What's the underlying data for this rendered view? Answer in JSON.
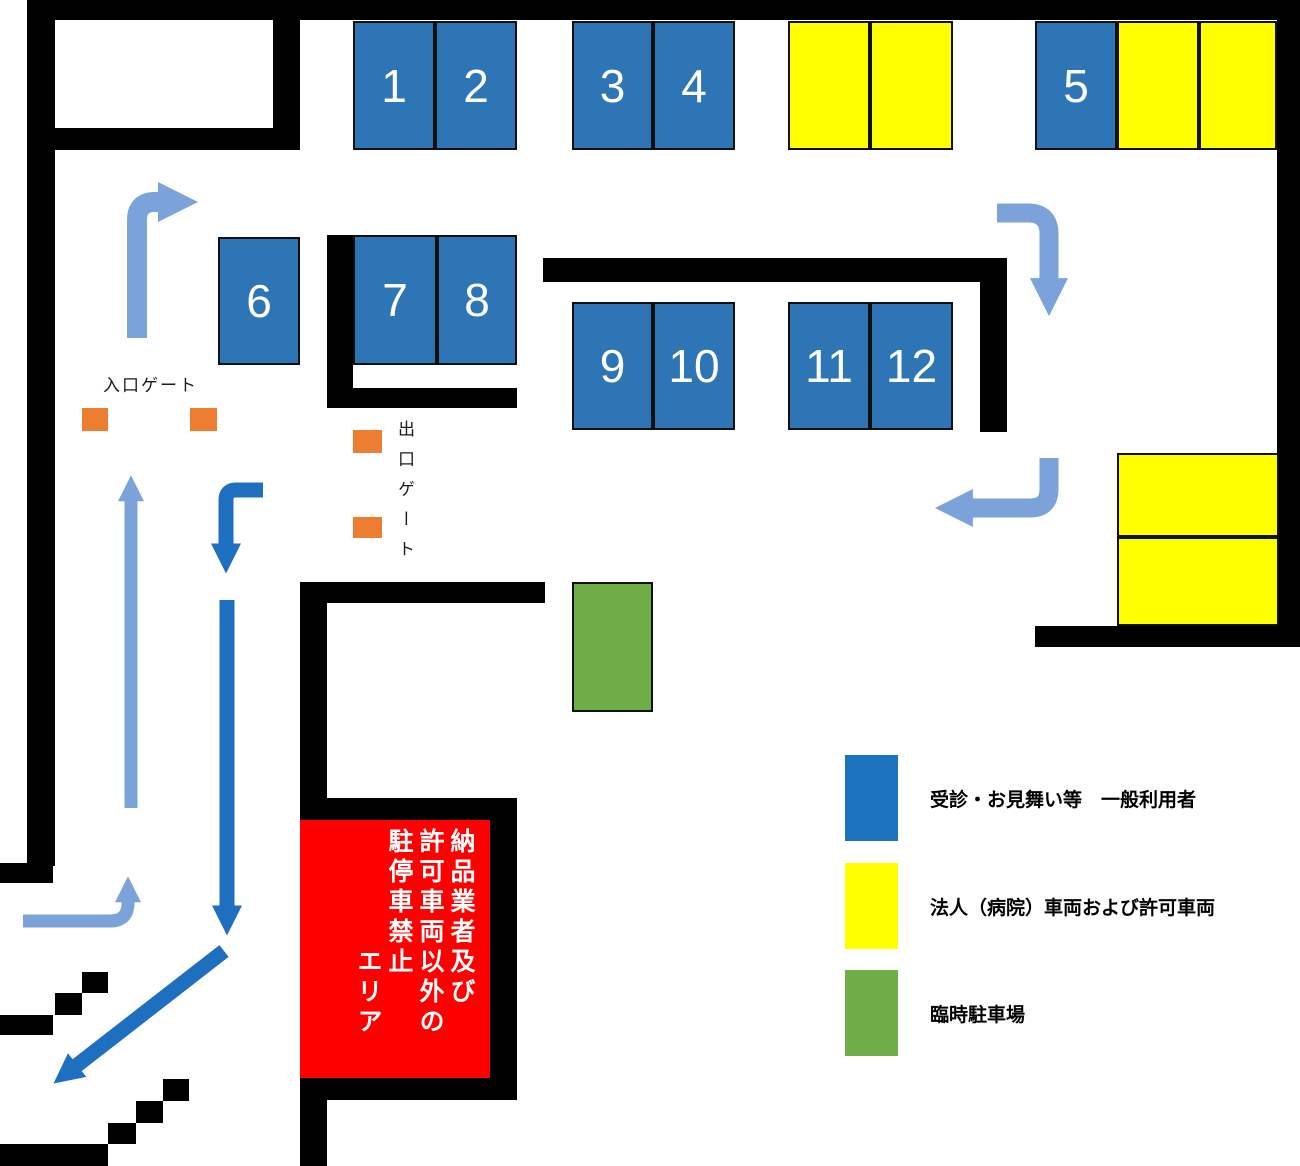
{
  "map": {
    "entrance_gate_label": "入口ゲート",
    "exit_gate_label": "出口ゲート",
    "stall_numbers": [
      "1",
      "2",
      "3",
      "4",
      "5",
      "6",
      "7",
      "8",
      "9",
      "10",
      "11",
      "12"
    ],
    "restricted_area_text": "納品業者及び\n許可車両以外の\n駐停車禁止\n　　　　エリア"
  },
  "legend": {
    "items": [
      {
        "label": "受診・お見舞い等　一般利用者",
        "color": "#1e73be"
      },
      {
        "label": "法人（病院）車両および許可車両",
        "color": "#ffff00"
      },
      {
        "label": "臨時駐車場",
        "color": "#70ad47"
      }
    ]
  },
  "colors": {
    "general_parking": "#2e75b6",
    "permitted_parking": "#ffff00",
    "temporary_parking": "#70ad47",
    "restricted_zone": "#ff0000",
    "gate": "#ed7d31",
    "wall": "#000000",
    "flow_in_arrow": "#7ba3d9",
    "flow_out_arrow": "#1f6fc0"
  }
}
